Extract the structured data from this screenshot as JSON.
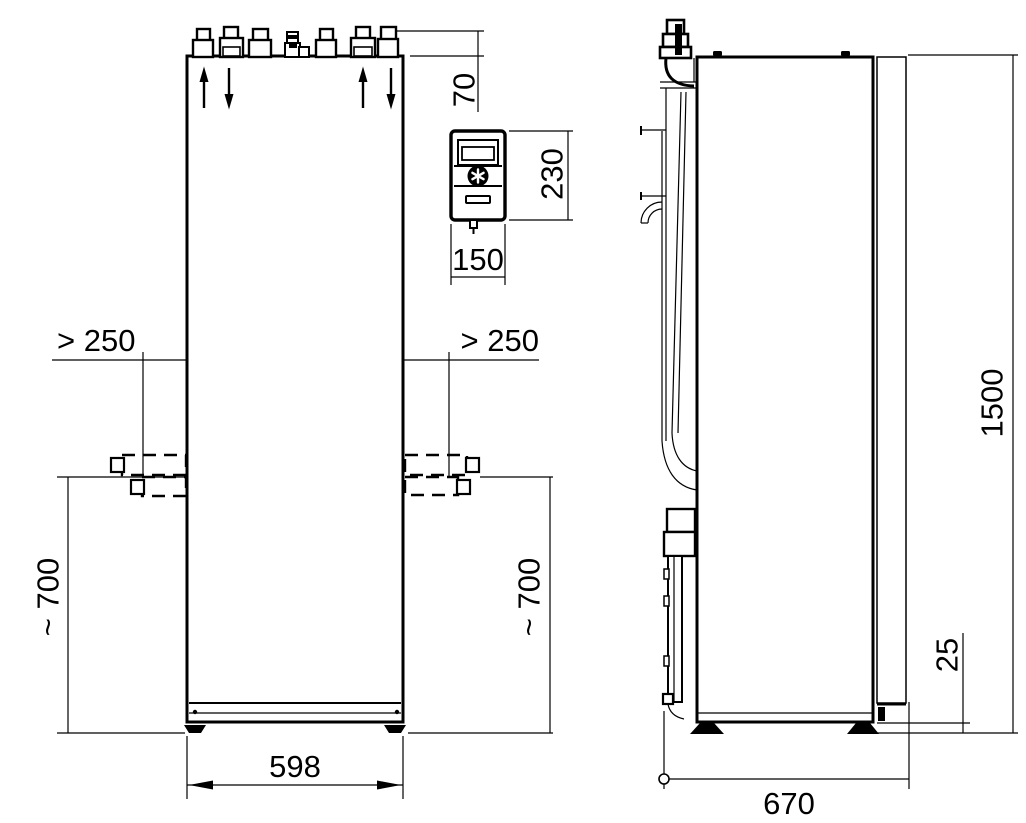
{
  "front_view": {
    "dims": {
      "connection_height": "70",
      "clearance_left": "> 250",
      "clearance_right": "> 250",
      "pipe_height_left": "~ 700",
      "pipe_height_right": "~ 700",
      "width": "598"
    }
  },
  "control_panel": {
    "dims": {
      "height": "230",
      "width": "150"
    },
    "icons": {
      "knob": "asterisk-knob"
    }
  },
  "side_view": {
    "dims": {
      "height": "1500",
      "base_clearance": "25",
      "depth": "670"
    }
  },
  "icons": {
    "flow_up_arrow": "up-arrow",
    "flow_down_arrow": "down-arrow"
  },
  "colors": {
    "line": "#000000",
    "background": "#ffffff"
  }
}
